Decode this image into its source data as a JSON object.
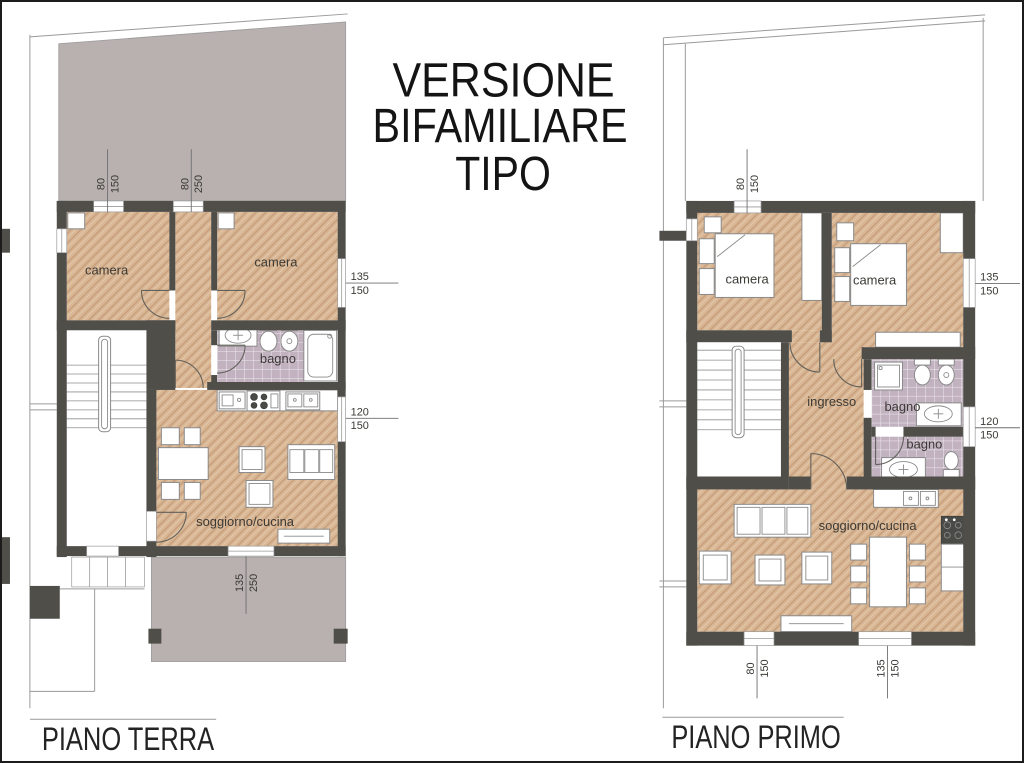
{
  "sheet": {
    "title_line1": "VERSIONE",
    "title_line2": "BIFAMILIARE",
    "title_line3": "TIPO"
  },
  "terra": {
    "label": "PIANO TERRA",
    "room_camera1": "camera",
    "room_camera2": "camera",
    "room_bagno": "bagno",
    "room_soggiorno": "soggiorno/cucina",
    "dim_top1_a": "80",
    "dim_top1_b": "150",
    "dim_top2_a": "80",
    "dim_top2_b": "250",
    "dim_right1_a": "135",
    "dim_right1_b": "150",
    "dim_right2_a": "120",
    "dim_right2_b": "150",
    "dim_bottom1_a": "135",
    "dim_bottom1_b": "250"
  },
  "primo": {
    "label": "PIANO PRIMO",
    "room_camera1": "camera",
    "room_camera2": "camera",
    "room_ingresso": "ingresso",
    "room_bagno1": "bagno",
    "room_bagno2": "bagno",
    "room_soggiorno": "soggiorno/cucina",
    "dim_top1_a": "80",
    "dim_top1_b": "150",
    "dim_right1_a": "135",
    "dim_right1_b": "150",
    "dim_right2_a": "120",
    "dim_right2_b": "150",
    "dim_bottom1_a": "80",
    "dim_bottom1_b": "150",
    "dim_bottom2_a": "135",
    "dim_bottom2_b": "150"
  },
  "colors": {
    "wall": "#4f4e49",
    "wood_floor": "#d9b795",
    "wood_stripe": "#c8a07d",
    "bath_tile": "#c2b2c0",
    "terrace": "#b9b0b0",
    "ink": "#141414"
  }
}
